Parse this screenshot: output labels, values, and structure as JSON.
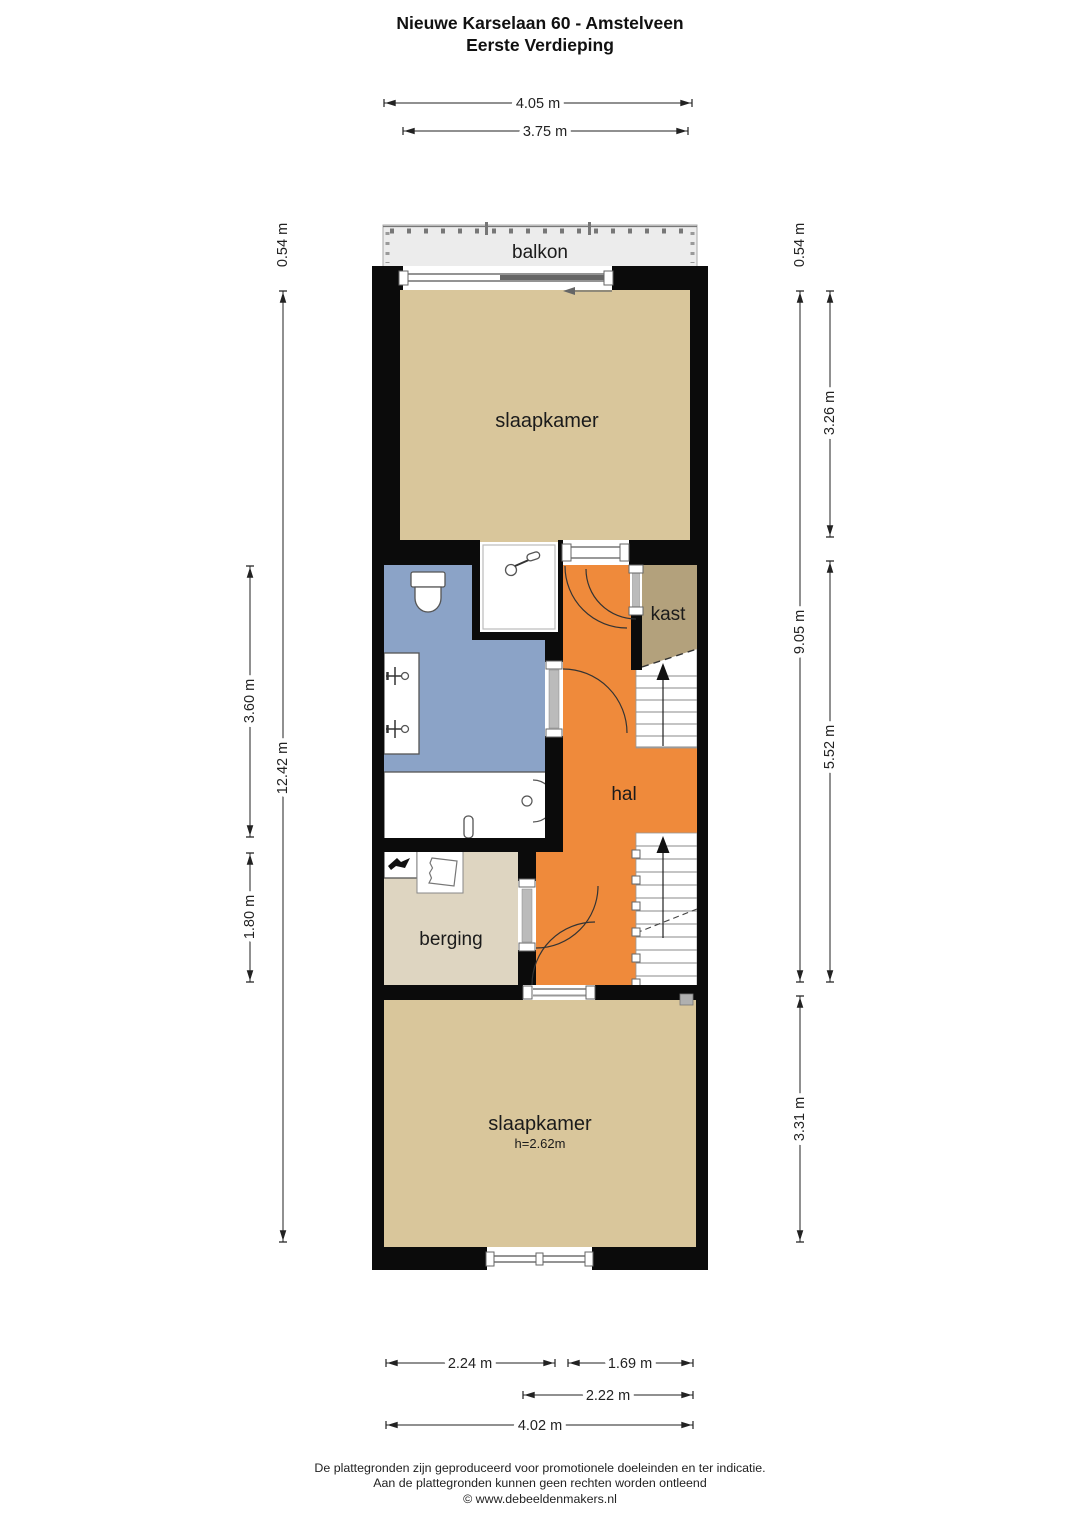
{
  "title": {
    "line1": "Nieuwe Karselaan 60 - Amstelveen",
    "line2": "Eerste Verdieping"
  },
  "rooms": {
    "balkon": "balkon",
    "slaapkamer_top": "slaapkamer",
    "kast": "kast",
    "hal": "hal",
    "berging": "berging",
    "slaapkamer_bottom": "slaapkamer",
    "slaapkamer_bottom_height": "h=2.62m"
  },
  "dimensions": {
    "top": {
      "overall": "4.05 m",
      "inner": "3.75 m"
    },
    "left": {
      "balcony_depth": "0.54 m",
      "total": "12.42 m",
      "bathroom": "3.60 m",
      "berging": "1.80 m"
    },
    "right": {
      "balcony_depth": "0.54 m",
      "upper_total": "9.05 m",
      "bedroom_top": "3.26 m",
      "hall": "5.52 m",
      "bedroom_bottom": "3.31 m"
    },
    "bottom": {
      "left_inner": "2.24 m",
      "right_inner": "1.69 m",
      "inner2": "2.22 m",
      "overall": "4.02 m"
    }
  },
  "footer": {
    "line1": "De plattegronden zijn geproduceerd voor promotionele doeleinden en ter indicatie.",
    "line2": "Aan de plattegronden kunnen geen rechten worden ontleend",
    "line3": "© www.debeeldenmakers.nl"
  },
  "colors": {
    "wall": "#0b0b0b",
    "room_tan": "#d9c69b",
    "kast_tan": "#b3a17c",
    "hal_orange": "#ef8a3b",
    "bath_blue": "#8ba3c7",
    "berging_beige": "#ded5c1",
    "balkon_grey": "#ececec"
  }
}
